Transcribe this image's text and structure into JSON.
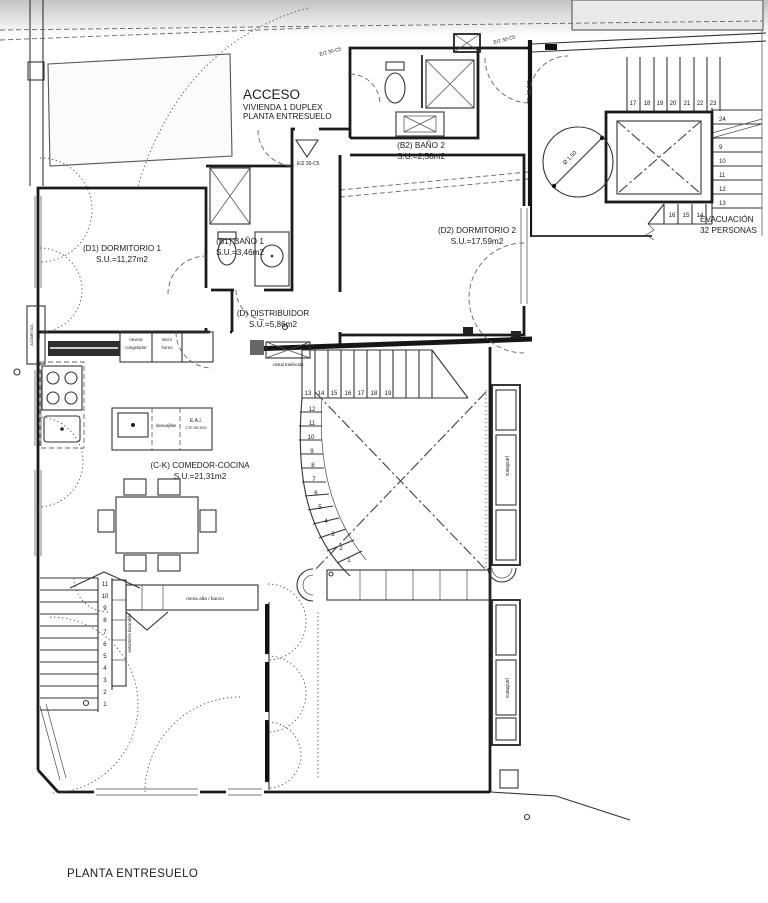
{
  "drawing": {
    "title": "PLANTA ENTRESUELO",
    "access": {
      "line1": "ACCESO",
      "line2": "VIVIENDA 1 DUPLEX",
      "line3": "PLANTA ENTRESUELO"
    },
    "rooms": {
      "d1": {
        "name": "(D1) DORMITORIO 1",
        "area": "S.U.=11,27m2"
      },
      "b1": {
        "name": "(B1) BAÑO 1",
        "area": "S.U.=3,46m2"
      },
      "b2": {
        "name": "(B2) BAÑO 2",
        "area": "S.U.=2,58m2"
      },
      "d2": {
        "name": "(D2) DORMITORIO 2",
        "area": "S.U.=17,59m2"
      },
      "dist": {
        "name": "(D) DISTRIBUIDOR",
        "area": "S.U.=5,86m2"
      },
      "ck": {
        "name": "(C-K) COMEDOR-COCINA",
        "area": "S.U.=21,31m2"
      }
    },
    "evacuation": {
      "line1": "EVACUACIÓN",
      "line2": "32 PERSONAS"
    },
    "labels": {
      "fire_rating": "EI2 30-C5",
      "nevera": "nevera",
      "congelador": "congelador",
      "micro": "micro",
      "horno": "horno",
      "lavavajillas": "lavavajillas",
      "eai": "E.A.I.",
      "eai_sub": "CTE DB HS2",
      "cristal": "cristal traslúcido",
      "mesa": "mesa alta / banco",
      "estanteria": "estantería barandilla",
      "jardinera": "jardinera",
      "acometida1": "ACOMETIDA",
      "acometida2": "GAS",
      "diameter": "Ø 1,50"
    },
    "stairs": {
      "central_top": [
        "13",
        "14",
        "15",
        "16",
        "17",
        "18",
        "19"
      ],
      "central_down": [
        "12",
        "11",
        "10",
        "9",
        "8",
        "7",
        "6",
        "5",
        "4",
        "3",
        "2",
        "1"
      ],
      "left": [
        "11",
        "10",
        "9",
        "8",
        "7",
        "6",
        "5",
        "4",
        "3",
        "2",
        "1"
      ],
      "evac_top": [
        "17",
        "18",
        "19",
        "20",
        "21",
        "22",
        "23"
      ],
      "evac_right": [
        "24",
        "9",
        "10",
        "11",
        "12",
        "13"
      ],
      "evac_bottom": [
        "16",
        "15",
        "14"
      ]
    }
  }
}
